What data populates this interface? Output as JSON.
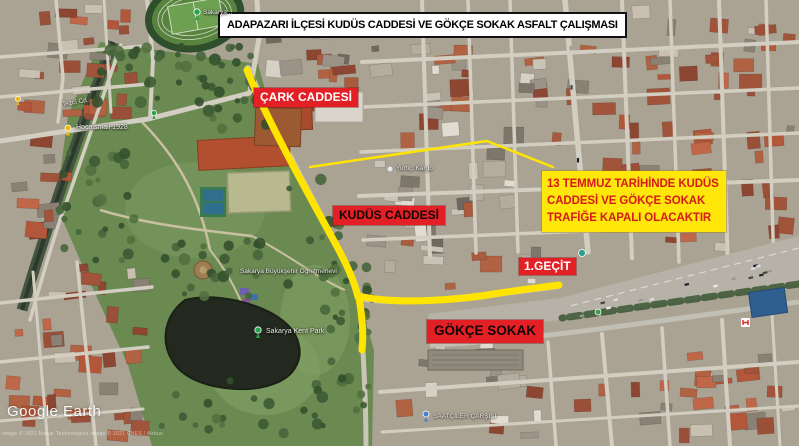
{
  "title_box": {
    "text": "ADAPAZARI İLÇESİ KUDÜS CADDESİ VE GÖKÇE SOKAK ASFALT ÇALIŞMASI"
  },
  "street_labels": {
    "cark": "ÇARK CADDESİ",
    "kudus": "KUDÜS CADDESİ",
    "gokce": "GÖKÇE SOKAK",
    "gecit": "1.GEÇİT"
  },
  "info_box": {
    "lines": [
      "13 TEMMUZ TARİHİNDE KUDÜS",
      "CADDESİ VE GÖKÇE SOKAK",
      "TRAFİĞE KAPALI OLACAKTIR"
    ]
  },
  "map_labels": {
    "tezci": "Tezci Cd.",
    "hocaismail": "Hocaismail 1928",
    "stadium": "Sakarya...",
    "ogretmenevi": "Sakarya Büyükşehir Öğretmenevi",
    "kentpark": "Sakarya Kent Park",
    "yurtici": "Yurtiçi Kargo",
    "carsi": "SAATÇİLER ÇARŞISI"
  },
  "watermark": {
    "brand": "Google Earth",
    "attribution": "Image © 2021 Maxar Technologies    Image © 2021 CNES / Airbus"
  },
  "colors": {
    "label_red": "#e32025",
    "highlight_yellow": "#ffe70a",
    "info_text_red": "#d61a1a",
    "route_yellow": "#ffe400"
  }
}
